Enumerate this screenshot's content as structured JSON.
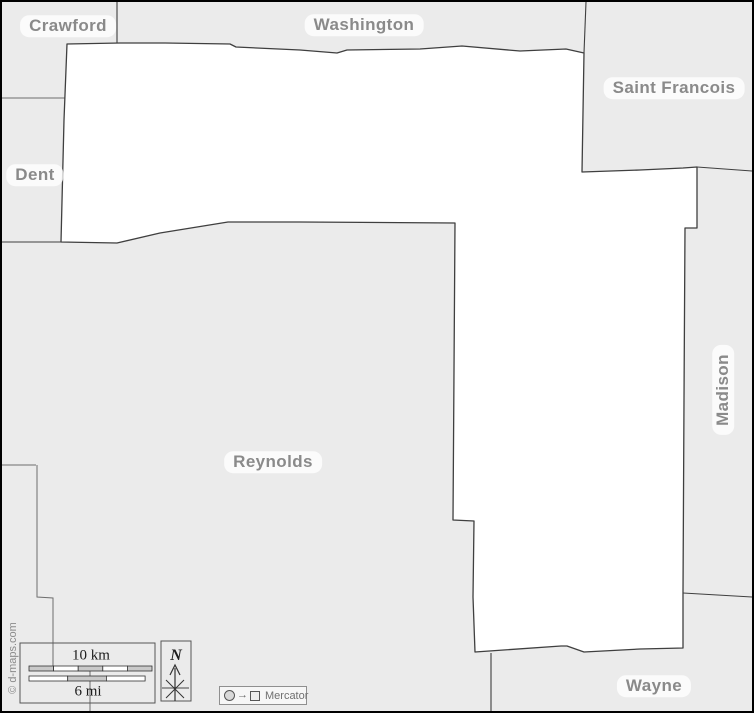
{
  "map": {
    "counties": {
      "crawford": "Crawford",
      "washington": "Washington",
      "saint_francois": "Saint Francois",
      "dent": "Dent",
      "madison": "Madison",
      "reynolds": "Reynolds",
      "wayne": "Wayne"
    },
    "scale_bar": {
      "km_label": "10 km",
      "mi_label": "6 mi"
    },
    "compass": {
      "north_label": "N"
    },
    "projection": {
      "label": "Mercator",
      "arrow_icon": "→"
    },
    "copyright": "© d-maps.com",
    "colors": {
      "neighbor-fill": "#ebebeb",
      "subject-fill": "#ffffff",
      "boundary": "#3f3f3f",
      "label-text": "#8a8a8a",
      "frame": "#000000"
    }
  }
}
